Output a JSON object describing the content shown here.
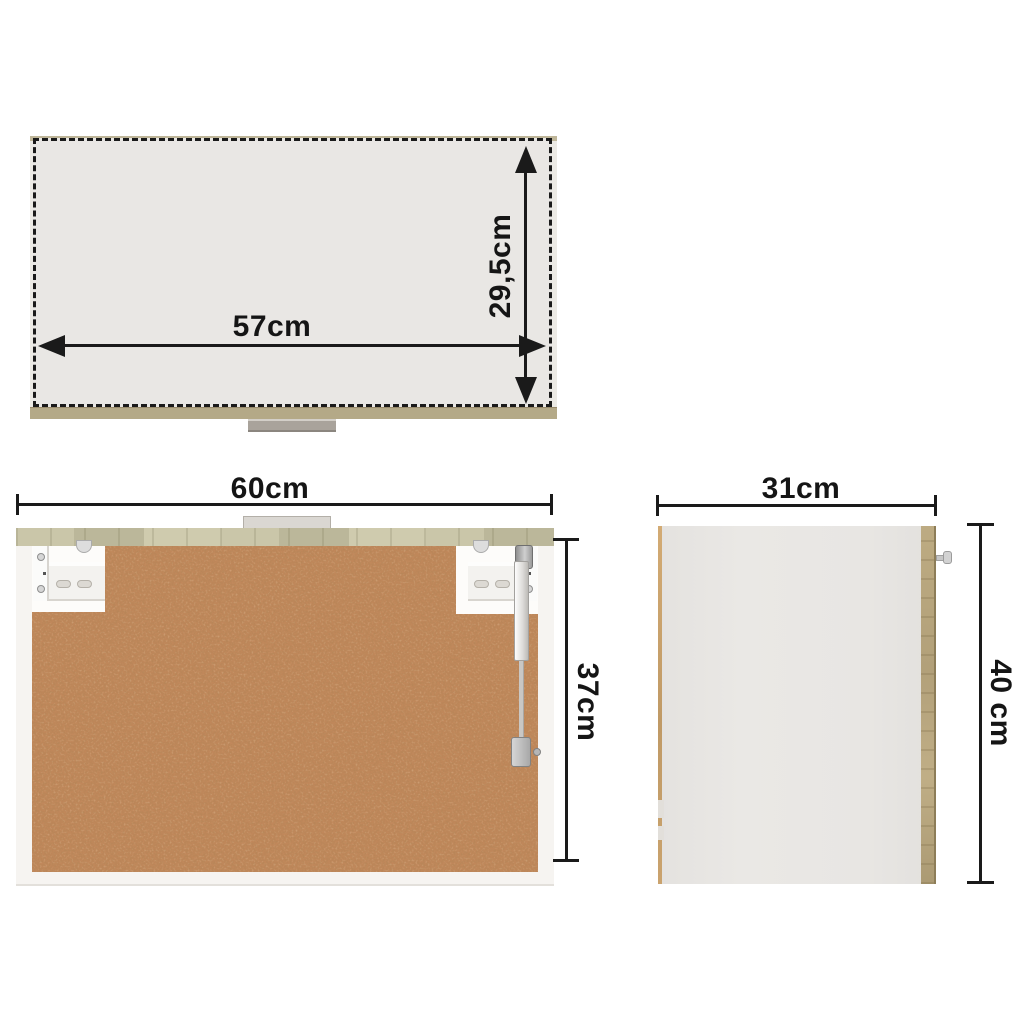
{
  "diagram": {
    "type": "furniture-dimension-diagram",
    "subject": "wall-hung-cabinet-three-views",
    "views": {
      "top_view": {
        "width_label": "57cm",
        "depth_label": "29,5cm"
      },
      "back_view": {
        "width_label": "60cm",
        "height_label": "37cm"
      },
      "side_view": {
        "depth_label": "31cm",
        "height_label": "40 cm"
      }
    },
    "colors": {
      "dimension_ink": "#1a1a1a",
      "oak_edge": "#b4a987",
      "back_top_strip": "#c6c2a6",
      "chipboard_brown": "#c0875a",
      "panel_gray": "#e9e7e4",
      "frame_white": "#f6f4f1",
      "background": "#ffffff"
    }
  }
}
